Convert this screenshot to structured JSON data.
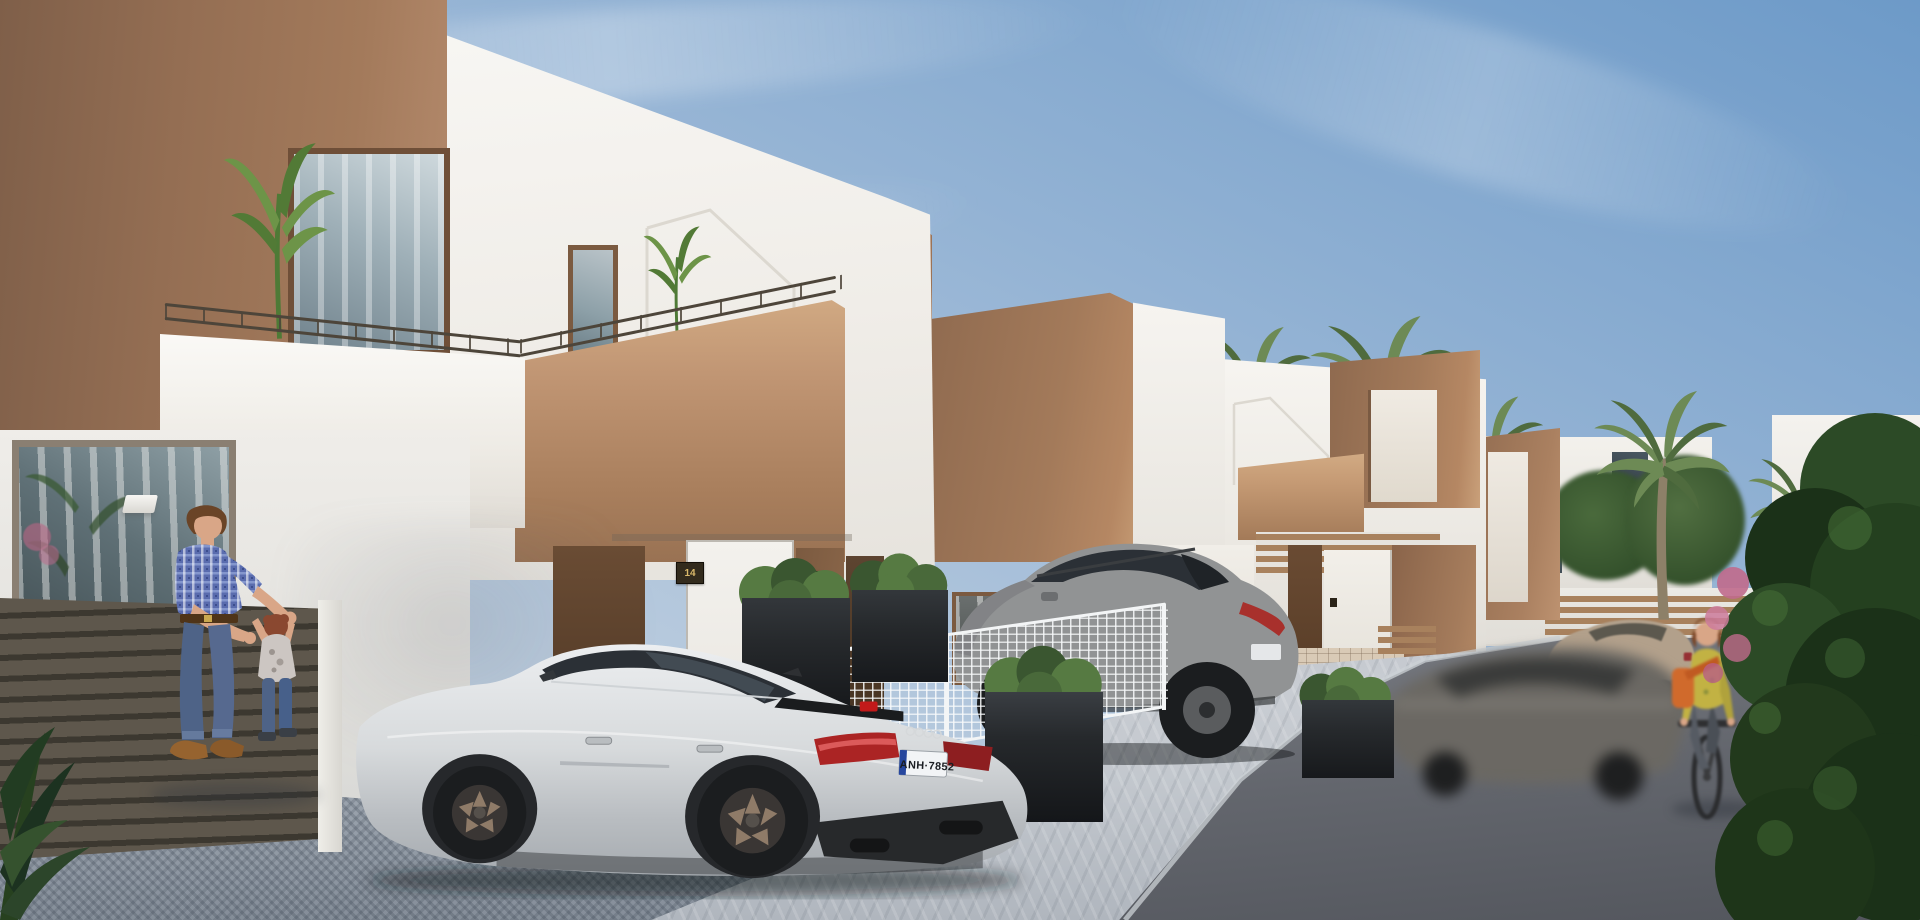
{
  "scene": {
    "style": "3D architectural visualization, sunny day",
    "setting": "new-build residential street with a row of modern two-storey townhouses",
    "description": "White and tan stucco townhouses with roof terraces and house-shaped facade trim recede to the right along a paved street; a silver sportback and a grey SUV are parked in driveways, a blurred car drives past, a father plays with his toddler on the left and a woman cycles past a large hedge on the right under palm trees."
  },
  "visible_text": {
    "license_plate": "ANH·7852",
    "house_number_left": "14",
    "house_number_right": "15"
  },
  "objects": {
    "vehicles": [
      {
        "name": "audi-sportback",
        "color_name": "silver",
        "plate": "ANH·7852"
      },
      {
        "name": "mazda-suv",
        "color_name": "grey"
      },
      {
        "name": "moving-car-blurred",
        "color_name": "dark grey"
      },
      {
        "name": "parked-suv",
        "color_name": "beige"
      },
      {
        "name": "bicycle",
        "color_name": "black"
      }
    ],
    "people": [
      {
        "name": "father",
        "clothing": "blue plaid shirt, jeans, brown shoes"
      },
      {
        "name": "toddler",
        "clothing": "grey printed t-shirt, jeans"
      },
      {
        "name": "cyclist-woman",
        "clothing": "yellow patterned blouse, orange shoulder bag, grey trousers"
      }
    ],
    "vegetation": [
      "banana plants on roof terrace",
      "palm trees along the street",
      "boxed shrubs in black planters",
      "large dark hedge with pink flowers on the right",
      "dark leafy plant in bottom-left corner"
    ],
    "architecture": [
      "tan stucco corner volumes",
      "white stucco facades with house-shaped trim outline",
      "roof terraces with thin metal railings",
      "recessed entrances with gold house-number plaques",
      "dark slatted timber fence",
      "white wire-mesh fence",
      "brown slatted fences",
      "beige tiled wainscot",
      "cobblestone driveway and asphalt street"
    ]
  },
  "palette": {
    "sky_top": "#6d9ac8",
    "sky_mid": "#9ab7d6",
    "sky_low": "#cdd8e2",
    "brown": "#a37a5a",
    "brown_dark": "#84614a",
    "brown_light": "#c49a73",
    "brown_lit": "#d2ab84",
    "white_wall": "#f6f4f0",
    "white_wall_shade": "#e6e3dd",
    "white_wall_dark": "#d4d2cc",
    "trim": "#dcd8d0",
    "door_dark": "#5a4130",
    "door_brown": "#7b5a40",
    "plaque_bg": "#332b1d",
    "plaque_text": "#d9b86a",
    "rail": "#4d453a",
    "fence_dark": "#5e574c",
    "fence_gap": "#3c3830",
    "fence_white": "#f3f5f6",
    "slat_brown": "#a8815d",
    "tile": "#d9cab6",
    "planter": "#26292c",
    "shrub": "#567a42",
    "shrub_dark": "#3a5630",
    "palm_leaf": "#6d8a55",
    "palm_leaf_dark": "#4f6b3e",
    "palm_trunk": "#8d8068",
    "bush": "#2c4a26",
    "bush_dark": "#1b3118",
    "bush_light": "#477138",
    "flower": "#c06a8c",
    "paver": "#c6cbd1",
    "paver_fore": "#99a1ab",
    "asphalt": "#6e7177",
    "asphalt_dark": "#55585f",
    "curb": "#ccd1d6",
    "silver": "#d7dadc",
    "silver_dark": "#a6abb0",
    "glass": "#2b3036",
    "glass_light": "#55616b",
    "red_tail": "#ab2424",
    "plate_bg": "#f2f4f6",
    "plate_blue": "#27479e",
    "plate_txt": "#1a1d22",
    "bronze": "#8f7b68",
    "mazda": "#919394",
    "mazda_dark": "#6c6e70",
    "blurcar": "#6b6862",
    "beige": "#b2a08b",
    "skin": "#d9a687",
    "hair_brown": "#6a4427",
    "shirt_blue": "#5a6cae",
    "shirt_blue_light": "#8fa0d4",
    "jeans": "#4e6387",
    "jeans_light": "#6b7fa3",
    "shoe": "#96632f",
    "child_hair": "#8a4830",
    "child_tee": "#ccc6c2",
    "top_yellow": "#c2b243",
    "bag_orange": "#d06a2c",
    "pants_grey": "#565b63"
  }
}
